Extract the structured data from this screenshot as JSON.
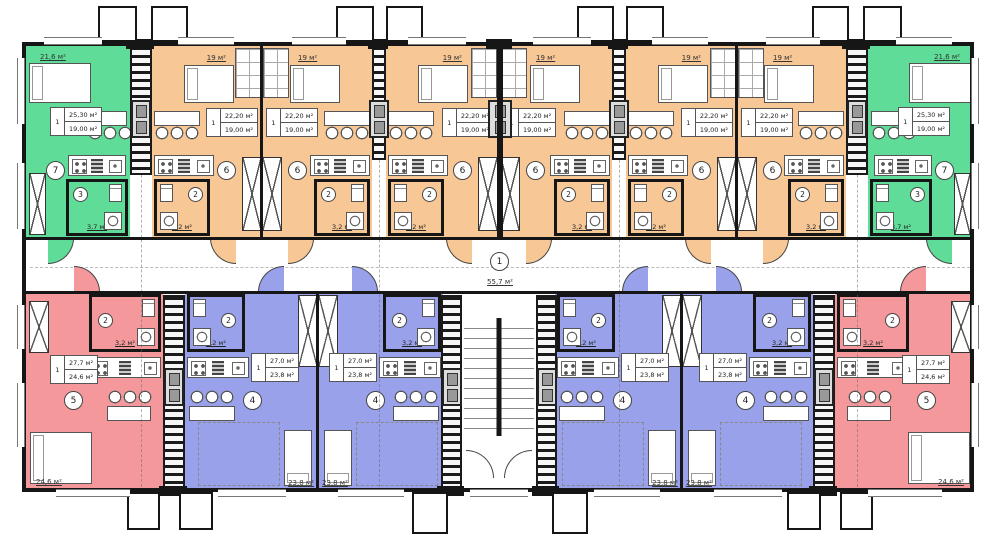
{
  "colors": {
    "green": "#5fdc98",
    "orange": "#f7c795",
    "blue": "#98a1e9",
    "red": "#f5989b",
    "wall": "#161616"
  },
  "stairwell": {
    "number": "1",
    "area": "55,7 м²"
  },
  "units": [
    {
      "id": "studio-green-left",
      "room_number": "7",
      "alcove_area": "21,6 м²",
      "flat_number": "1",
      "area_total": "25,30 м²",
      "area_living": "19,00 м²",
      "bath_number": "3",
      "bath_area": "3,7 м²"
    },
    {
      "id": "studio-orange-1",
      "room_number": "6",
      "alcove_area": "19 м²",
      "flat_number": "1",
      "area_total": "22,20 м²",
      "area_living": "19,00 м²",
      "bath_number": "2",
      "bath_area": "3,2 м²"
    },
    {
      "id": "studio-orange-2",
      "room_number": "6",
      "alcove_area": "19 м²",
      "flat_number": "1",
      "area_total": "22,20 м²",
      "area_living": "19,00 м²",
      "bath_number": "2",
      "bath_area": "3,2 м²"
    },
    {
      "id": "studio-orange-3",
      "room_number": "6",
      "alcove_area": "19 м²",
      "flat_number": "1",
      "area_total": "22,20 м²",
      "area_living": "19,00 м²",
      "bath_number": "2",
      "bath_area": "3,2 м²"
    },
    {
      "id": "studio-orange-4",
      "room_number": "6",
      "alcove_area": "19 м²",
      "flat_number": "1",
      "area_total": "22,20 м²",
      "area_living": "19,00 м²",
      "bath_number": "2",
      "bath_area": "3,2 м²"
    },
    {
      "id": "studio-orange-5",
      "room_number": "6",
      "alcove_area": "19 м²",
      "flat_number": "1",
      "area_total": "22,20 м²",
      "area_living": "19,00 м²",
      "bath_number": "2",
      "bath_area": "3,2 м²"
    },
    {
      "id": "studio-orange-6",
      "room_number": "6",
      "alcove_area": "19 м²",
      "flat_number": "1",
      "area_total": "22,20 м²",
      "area_living": "19,00 м²",
      "bath_number": "2",
      "bath_area": "3,2 м²"
    },
    {
      "id": "studio-green-right",
      "room_number": "7",
      "alcove_area": "21,6 м²",
      "flat_number": "1",
      "area_total": "25,30 м²",
      "area_living": "19,00 м²",
      "bath_number": "3",
      "bath_area": "3,7 м²"
    },
    {
      "id": "studio-red-left",
      "room_number": "5",
      "flat_number": "1",
      "area_total": "27,7 м²",
      "area_living": "24,6 м²",
      "bath_number": "2",
      "bath_area": "3,2 м²",
      "bed_area": "24,6 м²"
    },
    {
      "id": "studio-blue-1",
      "room_number": "4",
      "flat_number": "1",
      "area_total": "27,0 м²",
      "area_living": "23,8 м²",
      "bath_number": "2",
      "bath_area": "3,2 м²",
      "bed_area": "23,8 м²"
    },
    {
      "id": "studio-blue-2",
      "room_number": "4",
      "flat_number": "1",
      "area_total": "27,0 м²",
      "area_living": "23,8 м²",
      "bath_number": "2",
      "bath_area": "3,2 м²",
      "bed_area": "23,8 м²"
    },
    {
      "id": "studio-blue-3",
      "room_number": "4",
      "flat_number": "1",
      "area_total": "27,0 м²",
      "area_living": "23,8 м²",
      "bath_number": "2",
      "bath_area": "3,2 м²",
      "bed_area": "23,8 м²"
    },
    {
      "id": "studio-blue-4",
      "room_number": "4",
      "flat_number": "1",
      "area_total": "27,0 м²",
      "area_living": "23,8 м²",
      "bath_number": "2",
      "bath_area": "3,2 м²",
      "bed_area": "23,8 м²"
    },
    {
      "id": "studio-red-right",
      "room_number": "5",
      "flat_number": "1",
      "area_total": "27,7 м²",
      "area_living": "24,6 м²",
      "bath_number": "2",
      "bath_area": "3,2 м²",
      "bed_area": "24,6 м²"
    }
  ]
}
